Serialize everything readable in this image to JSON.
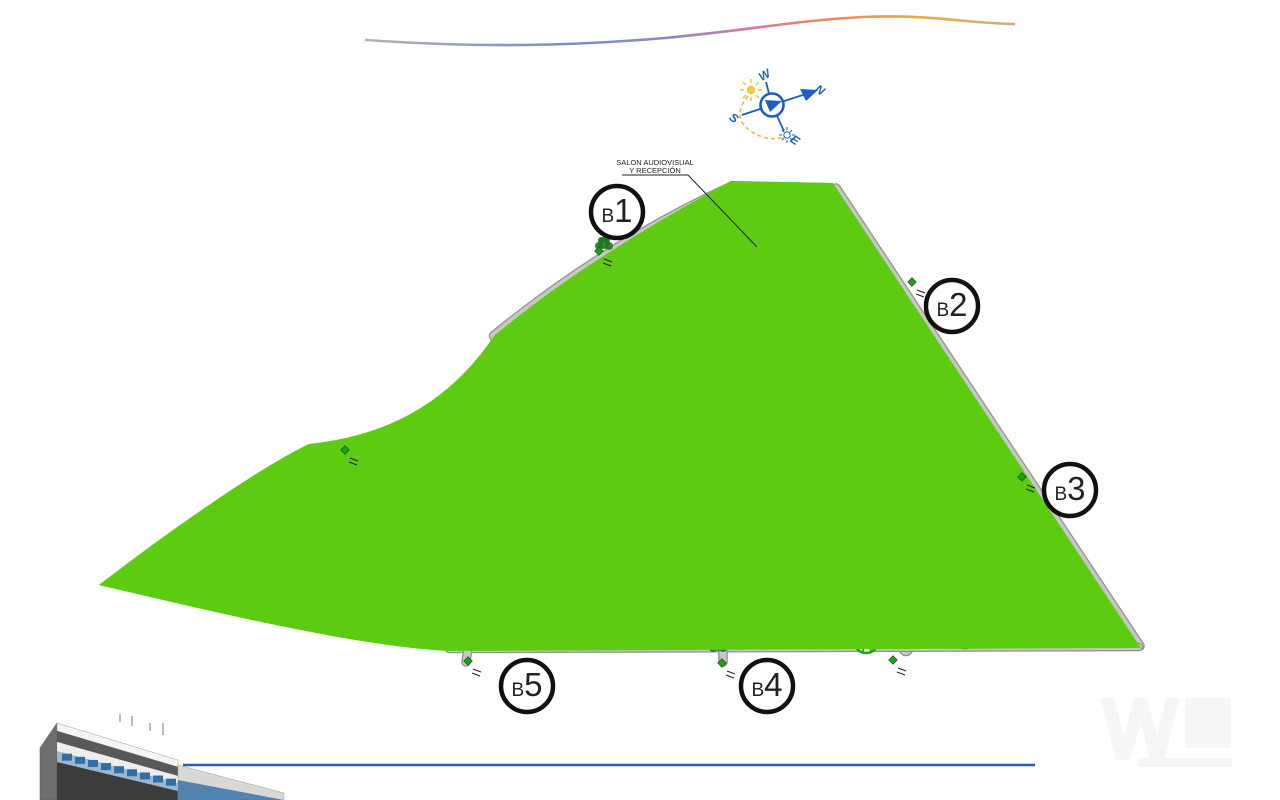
{
  "compass": {
    "north": "N",
    "south": "S",
    "east": "E",
    "west": "W"
  },
  "annotation": {
    "line1": "SALON AUDIOVISUAL",
    "line2": "Y RECEPCIÓN"
  },
  "labels": {
    "petanca": "PETANCA"
  },
  "blocks": [
    {
      "id": "B1",
      "label": "B1",
      "units": [
        [
          "01",
          "02",
          "03"
        ],
        [
          "04",
          "05",
          "06"
        ],
        [
          "07",
          "08",
          "09"
        ],
        [
          "10",
          "11",
          "12"
        ],
        [
          "13",
          "14",
          "15"
        ],
        [
          "16",
          "17",
          "18"
        ],
        [
          "19",
          "20",
          "21"
        ]
      ]
    },
    {
      "id": "B2",
      "label": "B2",
      "units": [
        [
          "22",
          "23",
          "24"
        ],
        [
          "25",
          "26",
          "27"
        ],
        [
          "28",
          "29",
          "30"
        ],
        [
          "31",
          "32",
          "33"
        ],
        [
          "34",
          "35",
          "36"
        ],
        [
          "37",
          "38",
          "39"
        ],
        [
          "40",
          "41",
          "42"
        ]
      ]
    },
    {
      "id": "B3",
      "label": "B3",
      "units": [
        [
          "43",
          "44",
          "45"
        ],
        [
          "46",
          "47",
          "48"
        ],
        [
          "49",
          "50",
          "51"
        ],
        [
          "52",
          "53",
          "54"
        ],
        [
          "55",
          "56",
          "57"
        ],
        [
          "58",
          "59",
          "60"
        ],
        [
          "61",
          "62",
          "63"
        ]
      ]
    },
    {
      "id": "B4",
      "label": "B4",
      "units": [
        [
          "84",
          "83",
          "82"
        ],
        [
          "81",
          "80",
          "79"
        ],
        [
          "78",
          "77",
          "76"
        ],
        [
          "75",
          "74",
          "73"
        ],
        [
          "72",
          "71",
          "70"
        ],
        [
          "69",
          "68",
          "67"
        ],
        [
          "66",
          "65",
          "64"
        ]
      ]
    },
    {
      "id": "B5",
      "label": "B5",
      "units": [
        [
          "108",
          "107",
          "106"
        ],
        [
          "105",
          "104",
          "103"
        ],
        [
          "102",
          "101",
          "100"
        ],
        [
          "99",
          "98",
          "97"
        ],
        [
          "96",
          "95",
          "94"
        ],
        [
          "93",
          "92",
          "91"
        ],
        [
          "90",
          "89",
          "88"
        ],
        [
          "87",
          "86",
          "85"
        ]
      ]
    }
  ],
  "colors": {
    "grass": "#5CCB12",
    "garden": "#00C24A",
    "spring": "#0CDC64",
    "road_fill": "#C9C7C4",
    "road_edge": "#8F8F8D",
    "plaza": "#B8B6B3",
    "boundary": "#A63FD0",
    "unit_fill": "#F7F5F0",
    "unit_number": "#4A4AC8",
    "pool_water": "#8080D6",
    "pool_deck": "#E9C36A",
    "tree": "#1F9E1F",
    "compass_blue": "#1B5FC0",
    "bottom_line": "#2B5EA7"
  }
}
